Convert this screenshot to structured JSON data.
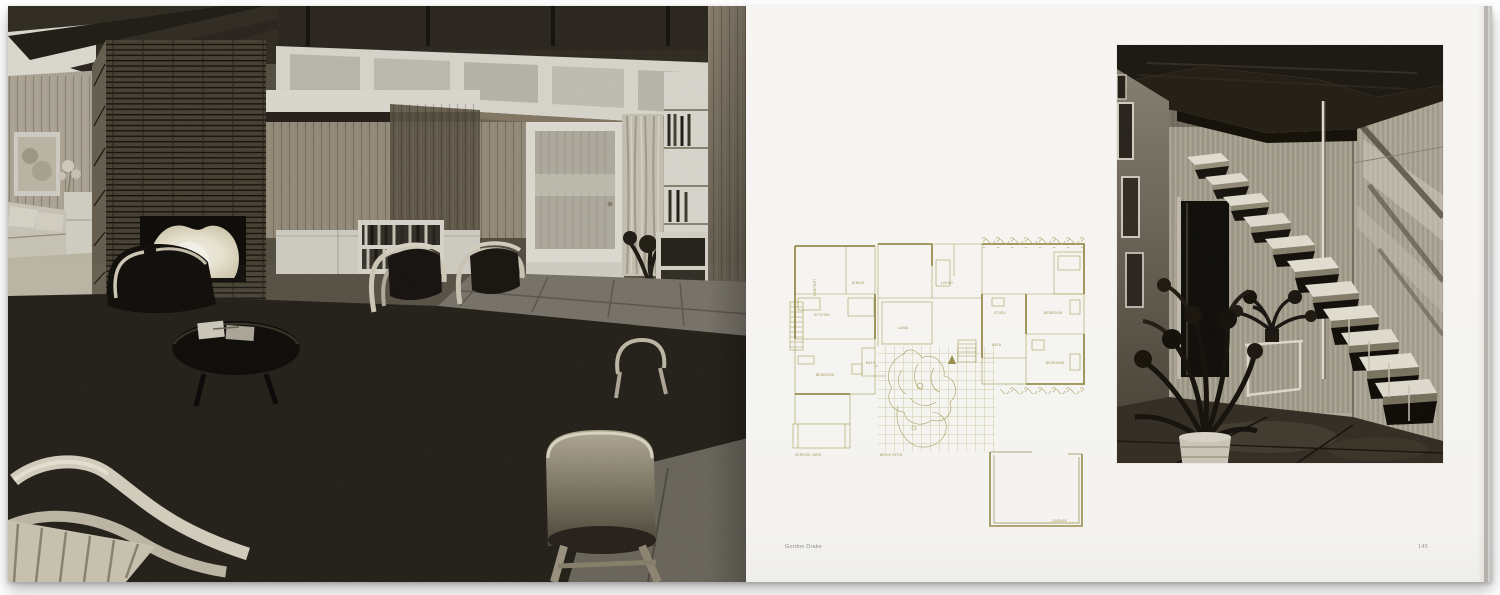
{
  "book": {
    "left_page": {
      "photo_alt": "Black-and-white photograph: mid-century living room with Roman-brick fireplace and lit fire, wood-panelled walls, clerestory windows, frosted glass door with curtain, bookshelves, Aalto bentwood armchairs and stool on dark carpet"
    },
    "right_page": {
      "credit": "Gordon Drake",
      "page_number": "145",
      "photo_alt": "Black-and-white photograph: open-riser floating staircase with steel pole, wood-panelled walls, framed pictures, potted plants and dark slab floor",
      "floor_plan": {
        "line_color": "#a79e5c",
        "labels": [
          {
            "text": "DINING"
          },
          {
            "text": "LIVING"
          },
          {
            "text": "KITCHEN"
          },
          {
            "text": "LANAI"
          },
          {
            "text": "BATH"
          },
          {
            "text": "BEDROOM"
          },
          {
            "text": "STUDY"
          },
          {
            "text": "BEDROOM"
          },
          {
            "text": "BATH"
          },
          {
            "text": "BEDROOM"
          },
          {
            "text": "SERVICE YARD"
          },
          {
            "text": "BRICK PATIO"
          },
          {
            "text": "GARAGE"
          },
          {
            "text": "CARPORT"
          }
        ]
      }
    }
  },
  "colors": {
    "paper": "#f6f5f2",
    "plan_line": "#a79e5c",
    "caption_text": "#8f8d88",
    "background": "#ffffff"
  }
}
